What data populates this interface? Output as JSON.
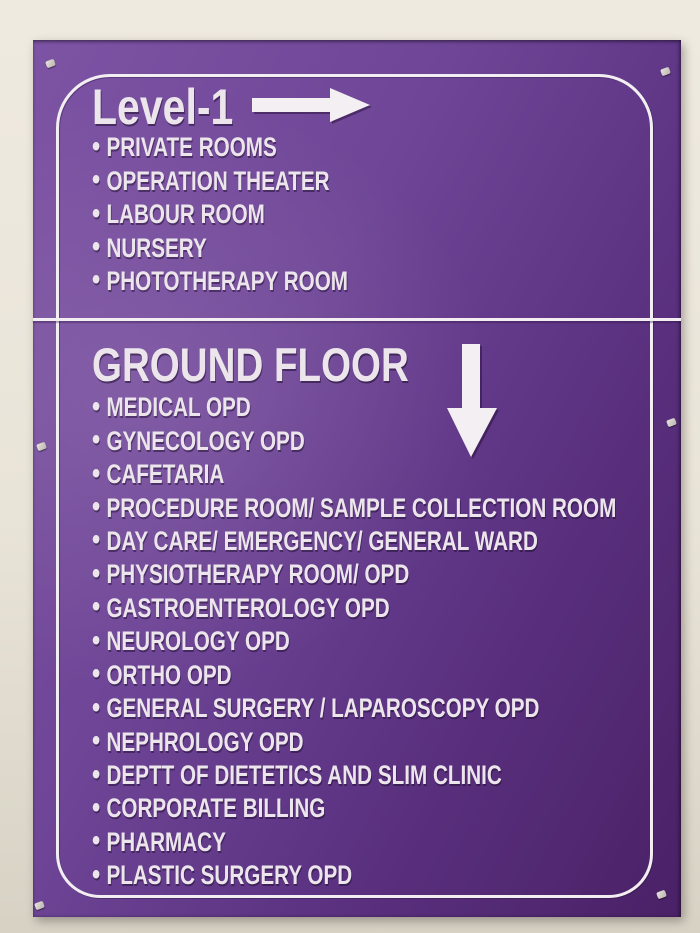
{
  "sign": {
    "bullet": "•",
    "sections": [
      {
        "title": "Level-1",
        "arrow_icon": "right-arrow",
        "items": [
          "PRIVATE ROOMS",
          "OPERATION THEATER",
          "LABOUR ROOM",
          "NURSERY",
          "PHOTOTHERAPY ROOM"
        ]
      },
      {
        "title": "GROUND FLOOR",
        "arrow_icon": "down-arrow",
        "items": [
          "MEDICAL OPD",
          "GYNECOLOGY OPD",
          "CAFETARIA",
          "PROCEDURE ROOM/ SAMPLE COLLECTION ROOM",
          "DAY CARE/ EMERGENCY/ GENERAL WARD",
          "PHYSIOTHERAPY ROOM/ OPD",
          "GASTROENTEROLOGY OPD",
          "NEUROLOGY OPD",
          "ORTHO OPD",
          "GENERAL SURGERY / LAPAROSCOPY OPD",
          "NEPHROLOGY OPD",
          "DEPTT OF DIETETICS AND SLIM CLINIC",
          "CORPORATE BILLING",
          "PHARMACY",
          "PLASTIC SURGERY OPD"
        ]
      }
    ]
  },
  "colors": {
    "wall_light": "#efeae0",
    "wall_mid": "#e9e4d8",
    "wall_dark": "#d7d2c4",
    "board_light": "#7d53a4",
    "board_mid": "#6f4697",
    "board_deep": "#5c3282",
    "board_dark": "#4a2166",
    "sign_text": "#ece6ec",
    "sign_border": "#f2eef2"
  }
}
